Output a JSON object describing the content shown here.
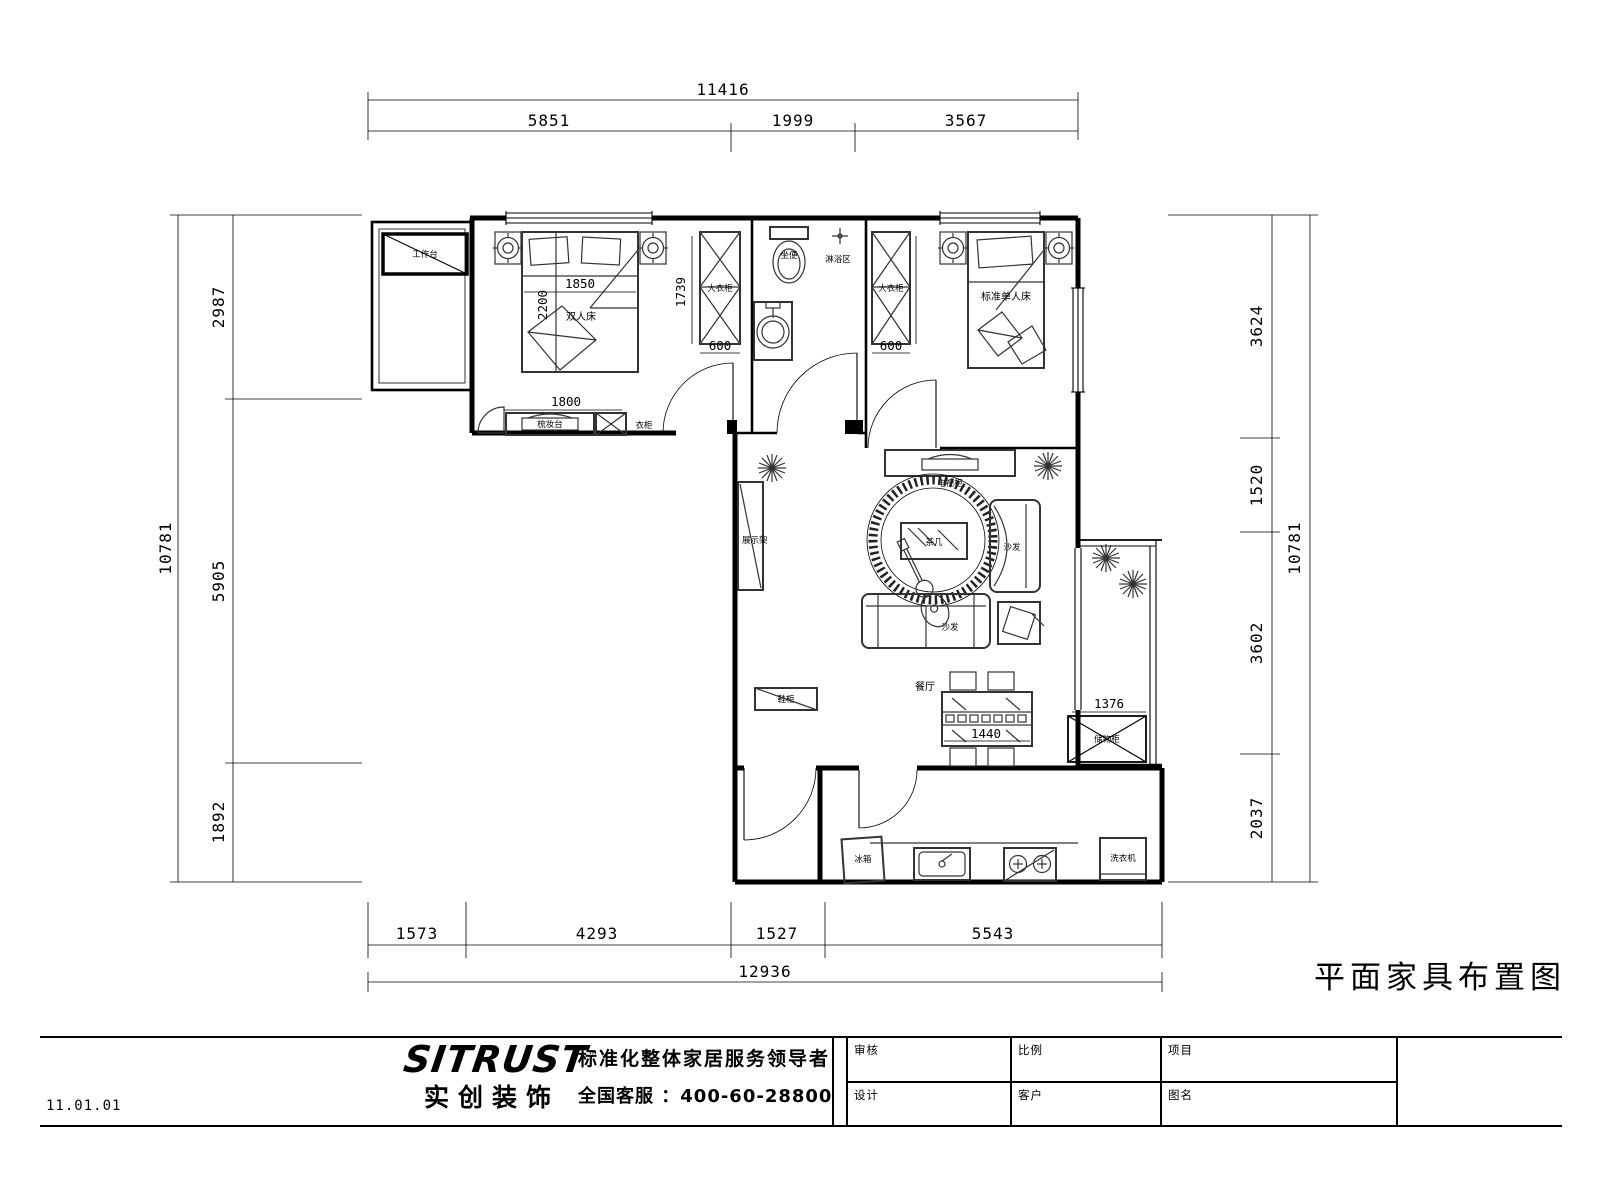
{
  "drawing_title": "平面家具布置图",
  "date_code": "11.01.01",
  "branding": {
    "logo": "SITRUST",
    "tm": "™",
    "logo_sub": "实创装饰",
    "slogan": "标准化整体家居服务领导者",
    "hotline": "全国客服 ：400-60-28800"
  },
  "title_block": {
    "review": "审核",
    "scale": "比例",
    "project": "项目",
    "design": "设计",
    "client": "客户",
    "drawing_name": "图名"
  },
  "dims": {
    "top": {
      "overall": "11416",
      "segments": [
        "5851",
        "1999",
        "3567"
      ]
    },
    "bottom": {
      "overall": "12936",
      "segments": [
        "1573",
        "4293",
        "1527",
        "5543"
      ]
    },
    "left": {
      "overall": "10781",
      "segments": [
        "2987",
        "5905",
        "1892"
      ]
    },
    "right": {
      "overall": "10781",
      "segments": [
        "3624",
        "1520",
        "3602",
        "2037"
      ]
    }
  },
  "plan": {
    "balcony_cabinet": "工作台",
    "bed_double": "双人床",
    "bed_single": "标准单人床",
    "wardrobe_left": "大衣柜",
    "wardrobe_right": "大衣柜",
    "dresser": "梳妆台",
    "closet": "衣柜",
    "toilet": "坐便",
    "shower_zone": "淋浴区",
    "display_shelf": "展示架",
    "shoe_cabinet": "鞋柜",
    "dining_room": "餐厅",
    "tv_cabinet": "电视柜",
    "tea_table": "茶几",
    "sofa": "沙发",
    "sofa_single": "沙发",
    "storage_cabinet": "储物柜",
    "fridge": "冰箱",
    "washer": "洗衣机"
  },
  "plan_dims": {
    "d1850": "1850",
    "d2200": "2200",
    "d1739": "1739",
    "d600_left": "600",
    "d1800": "1800",
    "d600_right": "600",
    "d1440": "1440",
    "d1376": "1376"
  }
}
